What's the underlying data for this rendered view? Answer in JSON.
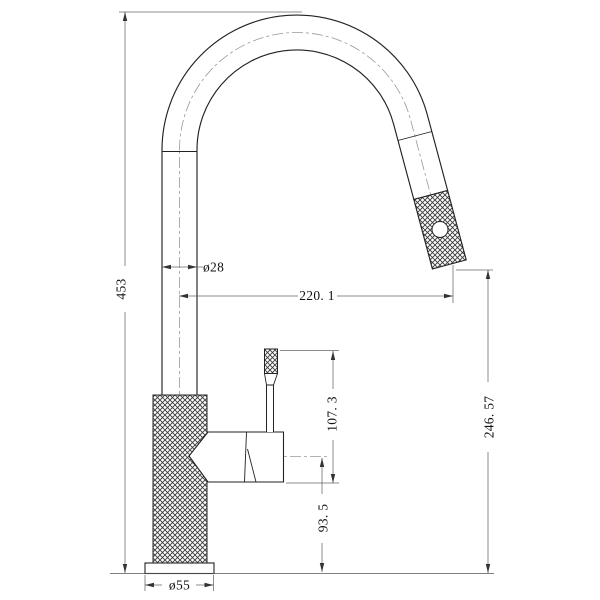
{
  "drawing": {
    "subject": "pull-out-kitchen-faucet-technical-drawing",
    "style": "2d-cad-line-drawing",
    "colors": {
      "background": "#ffffff",
      "object_line": "#222222",
      "dimension_line": "#666666",
      "centerline": "#999999",
      "knurl_hatch": "#3a3a3a"
    },
    "dims": {
      "overall_height": "453",
      "spout_tube_diameter": "ø28",
      "spout_reach": "220. 1",
      "outlet_clearance_height": "246. 57",
      "lever_top_height": "107. 3",
      "handle_axis_height": "93. 5",
      "base_diameter": "ø55"
    },
    "parts": [
      "gooseneck-spout",
      "knurled-spray-head",
      "spray-outlet-hole",
      "knurled-body",
      "base-plate",
      "handle-housing",
      "handle-lever",
      "knurled-lever-grip"
    ]
  }
}
